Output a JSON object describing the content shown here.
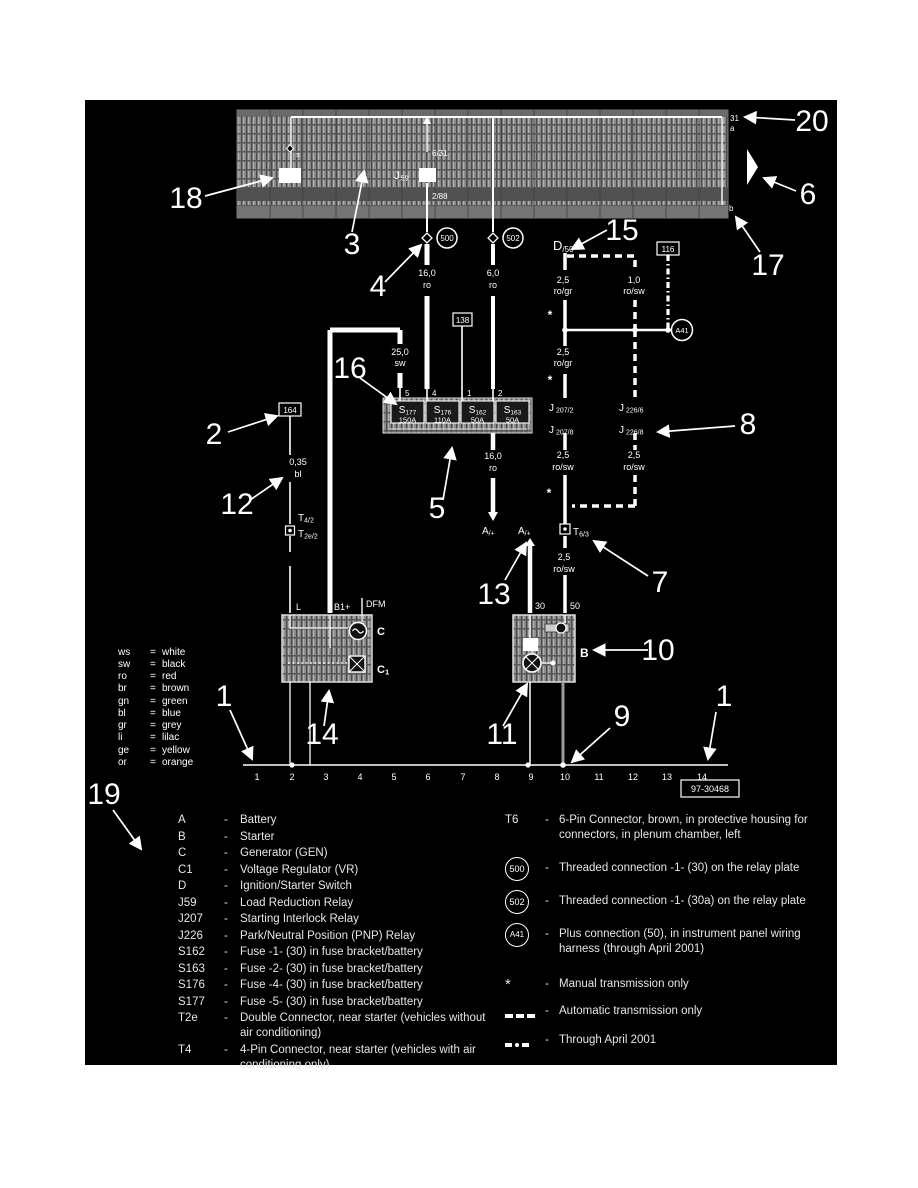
{
  "page": {
    "part_number": "97-30468"
  },
  "misc": {
    "eq": "=",
    "dash": "-"
  },
  "colors": {
    "background": "#000000",
    "foreground": "#ffffff",
    "panel_gray": "#8a8a8a"
  },
  "panel": {
    "rail_label": "31",
    "rail_a": "a",
    "rail_b": "b",
    "pos3": "3",
    "pos3_pin": "s",
    "relay_main": "J",
    "relay_sub": "59",
    "relay_pin_top": "6/31",
    "relay_pin2_box": "2",
    "relay_pin_bottom": "2/88"
  },
  "connectors": {
    "c500": "500",
    "c502": "502",
    "a41": "A41",
    "box116": "116",
    "box138": "138",
    "box164": "164"
  },
  "wires": {
    "w1_size": "16,0",
    "w1_color": "ro",
    "w2_size": "6,0",
    "w2_color": "ro",
    "w3_size": "25,0",
    "w3_color": "sw",
    "w4_size": "0,35",
    "w4_color": "bl",
    "w5_size": "2,5",
    "w5_color": "ro/gr",
    "w6_size": "1,0",
    "w6_color": "ro/sw",
    "w7_size": "2,5",
    "w7_color": "ro/gr",
    "w8_size": "2,5",
    "w8_color": "ro/sw",
    "w9_size": "2,5",
    "w9_color": "ro/sw",
    "w10_size": "2,5",
    "w10_color": "ro/sw",
    "w11_size": "16,0",
    "w11_color": "ro",
    "asterisk": "*"
  },
  "relays": {
    "j207_a_main": "J",
    "j207_a_sub": "207/2",
    "j207_b_main": "J",
    "j207_b_sub": "207/8",
    "j226_a_main": "J",
    "j226_a_sub": "226/6",
    "j226_b_main": "J",
    "j226_b_sub": "226/8"
  },
  "tconnectors": {
    "d50_main": "D",
    "d50_sub": "/50",
    "t42_main": "T",
    "t42_sub": "4/2",
    "t2e2_main": "T",
    "t2e2_sub": "2e/2",
    "t63_main": "T",
    "t63_sub": "6/3",
    "aplus1_main": "A",
    "aplus1_sub": "/+",
    "aplus2_main": "A",
    "aplus2_sub": "/+"
  },
  "fuses": {
    "block": [
      {
        "main": "S",
        "sub": "177",
        "amp": "150A",
        "pin": "5"
      },
      {
        "main": "S",
        "sub": "176",
        "amp": "110A",
        "pin": "4"
      },
      {
        "main": "S",
        "sub": "162",
        "amp": "50A",
        "pin": "1"
      },
      {
        "main": "S",
        "sub": "163",
        "amp": "50A",
        "pin": "2"
      }
    ]
  },
  "generator": {
    "t_l": "L",
    "t_b1": "B1+",
    "t_dfm": "DFM",
    "c": "C",
    "c1_main": "C",
    "c1_sub": "1"
  },
  "starter": {
    "t30": "30",
    "t50": "50",
    "b": "B"
  },
  "tracks": [
    "1",
    "2",
    "3",
    "4",
    "5",
    "6",
    "7",
    "8",
    "9",
    "10",
    "11",
    "12",
    "13",
    "14"
  ],
  "callouts": {
    "n1": "1",
    "n2": "2",
    "n3": "3",
    "n4": "4",
    "n5": "5",
    "n6": "6",
    "n7": "7",
    "n8": "8",
    "n9": "9",
    "n10": "10",
    "n11": "11",
    "n12": "12",
    "n13": "13",
    "n14": "14",
    "n15": "15",
    "n16": "16",
    "n17": "17",
    "n18": "18",
    "n19": "19",
    "n20": "20"
  },
  "color_legend": [
    {
      "code": "ws",
      "name": "white"
    },
    {
      "code": "sw",
      "name": "black"
    },
    {
      "code": "ro",
      "name": "red"
    },
    {
      "code": "br",
      "name": "brown"
    },
    {
      "code": "gn",
      "name": "green"
    },
    {
      "code": "bl",
      "name": "blue"
    },
    {
      "code": "gr",
      "name": "grey"
    },
    {
      "code": "li",
      "name": "lilac"
    },
    {
      "code": "ge",
      "name": "yellow"
    },
    {
      "code": "or",
      "name": "orange"
    }
  ],
  "legend_left": [
    {
      "label": "A",
      "desc": "Battery"
    },
    {
      "label": "B",
      "desc": "Starter"
    },
    {
      "label": "C",
      "desc": "Generator (GEN)"
    },
    {
      "label": "C1",
      "desc": "Voltage Regulator (VR)"
    },
    {
      "label": "D",
      "desc": "Ignition/Starter Switch"
    },
    {
      "label": "J59",
      "desc": "Load Reduction Relay"
    },
    {
      "label": "J207",
      "desc": "Starting Interlock Relay"
    },
    {
      "label": "J226",
      "desc": "Park/Neutral Position (PNP) Relay"
    },
    {
      "label": "S162",
      "desc": "Fuse -1- (30) in fuse bracket/battery"
    },
    {
      "label": "S163",
      "desc": "Fuse -2- (30) in fuse bracket/battery"
    },
    {
      "label": "S176",
      "desc": "Fuse -4- (30) in fuse bracket/battery"
    },
    {
      "label": "S177",
      "desc": "Fuse -5- (30) in fuse bracket/battery"
    },
    {
      "label": "T2e",
      "desc": "Double Connector, near starter (vehicles without air conditioning)"
    },
    {
      "label": "T4",
      "desc": "4-Pin Connector, near starter (vehicles with air conditioning only)"
    }
  ],
  "legend_right": [
    {
      "sym": "T6",
      "desc": "6-Pin Connector, brown, in protective housing for connectors, in plenum chamber, left"
    },
    {
      "sym": "500",
      "desc": "Threaded connection -1- (30) on the relay plate"
    },
    {
      "sym": "502",
      "desc": "Threaded connection -1- (30a) on the relay plate"
    },
    {
      "sym": "A41",
      "desc": "Plus connection (50), in instrument panel wiring harness (through April 2001)"
    }
  ],
  "legend_notes": [
    {
      "sym": "*",
      "desc": "Manual transmission only"
    },
    {
      "desc": "Automatic transmission only"
    },
    {
      "desc": "Through April 2001"
    }
  ]
}
